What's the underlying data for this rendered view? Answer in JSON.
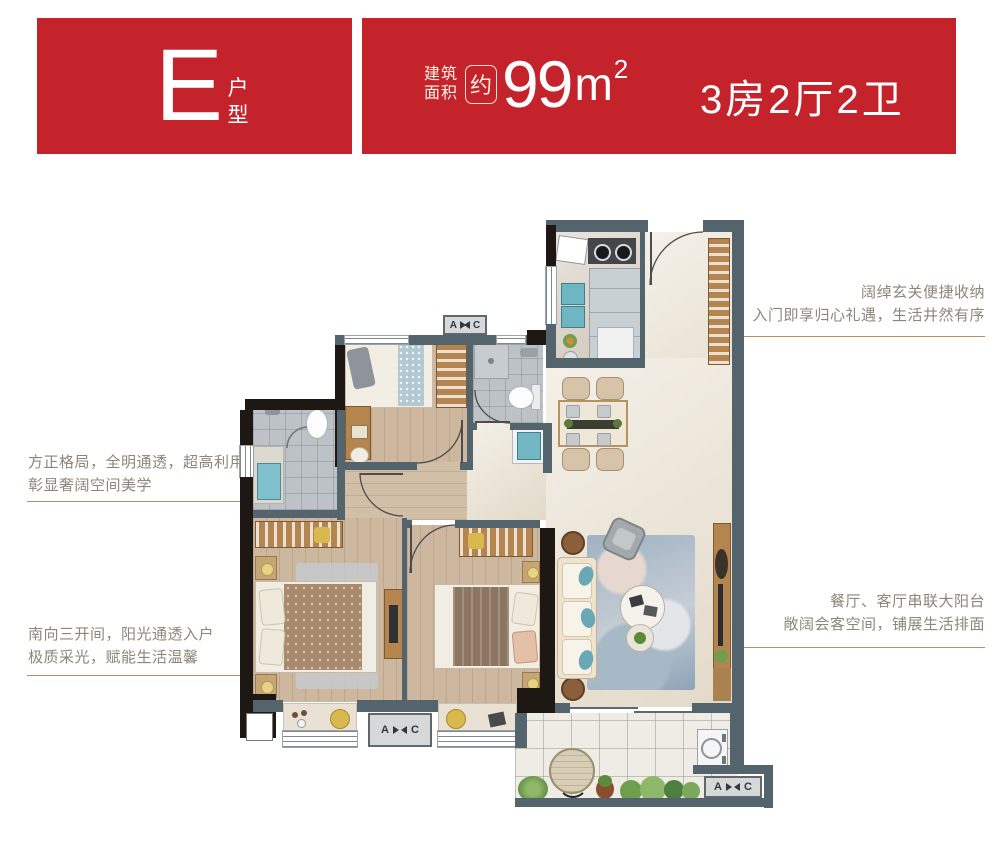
{
  "header": {
    "unit_letter": "E",
    "unit_type_label": "户型",
    "area_prefix_line1": "建筑",
    "area_prefix_line2": "面积",
    "area_approx": "约",
    "area_value": "99",
    "area_unit": "m",
    "area_unit_sup": "2",
    "layout_label": "3房2厅2卫",
    "bg_color": "#c5232c",
    "text_color": "#ffffff"
  },
  "annotations": [
    {
      "id": "entry",
      "line1": "阔绰玄关便捷收纳",
      "line2": "入门即享归心礼遇，生活井然有序",
      "align": "right"
    },
    {
      "id": "layout",
      "line1": "方正格局，全明通透，超高利用率",
      "line2": "彰显奢阔空间美学",
      "align": "left"
    },
    {
      "id": "living",
      "line1": "餐厅、客厅串联大阳台",
      "line2": "敞阔会客空间，铺展生活排面",
      "align": "right"
    },
    {
      "id": "south",
      "line1": "南向三开间，阳光通透入户",
      "line2": "极质采光，赋能生活温馨",
      "align": "left"
    }
  ],
  "plan": {
    "ac": {
      "a": "A",
      "c": "C"
    },
    "colors": {
      "wall_exterior": "#1d1813",
      "wall_interior": "#54646d",
      "leader_line": "#bf8c5a",
      "annotation_text": "#8f8578",
      "wood_floor": "#cdb89f",
      "marble_floor": "#eae2d2",
      "bath_tile": "#bcc2c6",
      "balcony_tile": "#eeece5",
      "accent_teal": "#6fb6c3",
      "cabinet_wood": "#b5854f",
      "rug_blue": "#9fb2c4"
    }
  }
}
